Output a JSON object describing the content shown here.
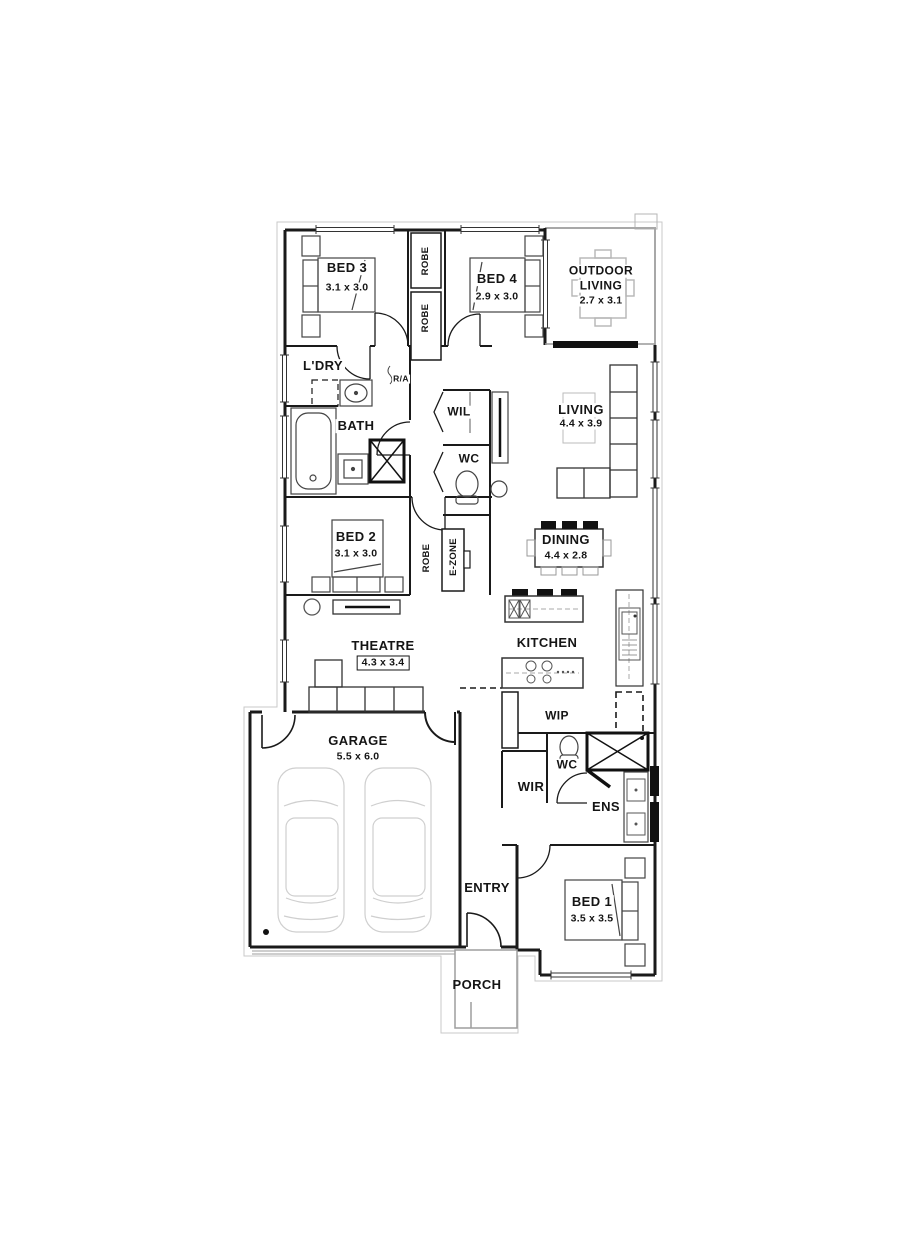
{
  "rooms": {
    "bed3": {
      "name": "BED 3",
      "dims": "3.1 x 3.0"
    },
    "bed4": {
      "name": "BED 4",
      "dims": "2.9 x 3.0"
    },
    "outdoor_living": {
      "name_line1": "OUTDOOR",
      "name_line2": "LIVING",
      "dims": "2.7 x 3.1"
    },
    "laundry": {
      "name": "L'DRY"
    },
    "return_air": {
      "name": "R/A"
    },
    "bath": {
      "name": "BATH"
    },
    "walk_in_linen": {
      "name": "WIL"
    },
    "wc_hall": {
      "name": "WC"
    },
    "living": {
      "name": "LIVING",
      "dims": "4.4 x 3.9"
    },
    "bed2": {
      "name": "BED 2",
      "dims": "3.1 x 3.0"
    },
    "robe": {
      "name": "ROBE"
    },
    "ezone": {
      "name": "E-ZONE"
    },
    "dining": {
      "name": "DINING",
      "dims": "4.4 x 2.8"
    },
    "theatre": {
      "name": "THEATRE",
      "dims": "4.3 x 3.4"
    },
    "kitchen": {
      "name": "KITCHEN"
    },
    "wip": {
      "name": "WIP"
    },
    "garage": {
      "name": "GARAGE",
      "dims": "5.5 x 6.0"
    },
    "wc_ens": {
      "name": "WC"
    },
    "wir": {
      "name": "WIR"
    },
    "ens": {
      "name": "ENS"
    },
    "entry": {
      "name": "ENTRY"
    },
    "bed1": {
      "name": "BED 1",
      "dims": "3.5 x 3.5"
    },
    "porch": {
      "name": "PORCH"
    }
  },
  "colors": {
    "wall": "#1a1a1a",
    "light_outline": "#bdbdbd",
    "furniture": "#555555"
  }
}
